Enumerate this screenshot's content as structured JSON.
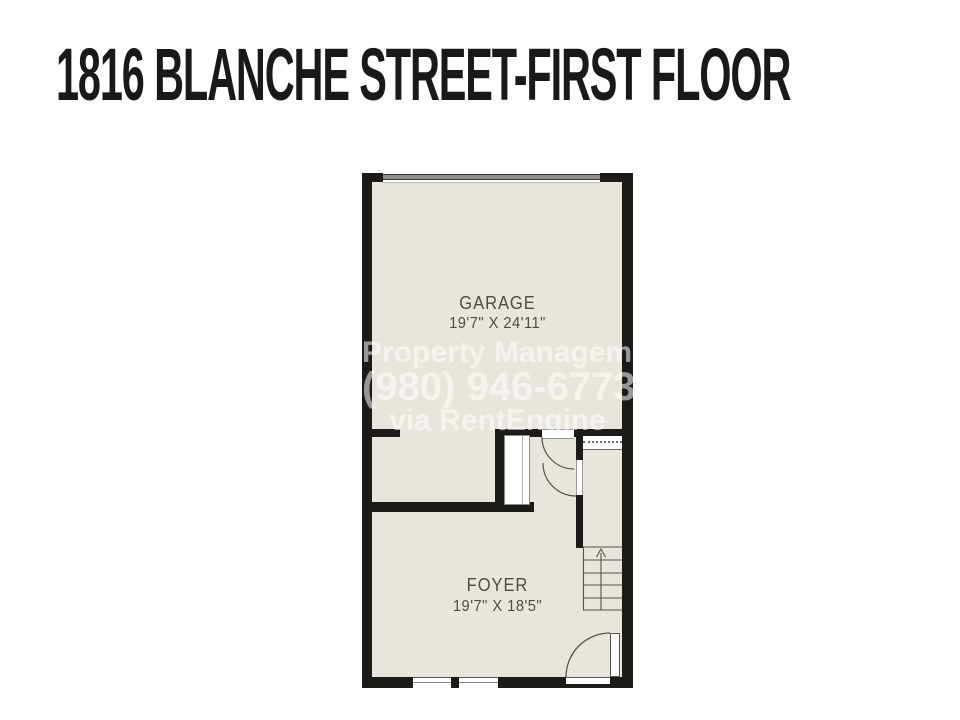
{
  "title": "1816 BLANCHE STREET-FIRST FLOOR",
  "floorplan": {
    "rooms": [
      {
        "name": "GARAGE",
        "dims": "19'7\" X 24'11\""
      },
      {
        "name": "FOYER",
        "dims": "19'7\" X 18'5\""
      }
    ],
    "watermark": {
      "line1": "Property Management",
      "line2": "(980) 946-6773",
      "line3": "via RentEngine"
    },
    "stairs": {
      "direction": "up"
    },
    "colors": {
      "wall": "#1d1b18",
      "floor": "#e9e5dc",
      "label": "#4e4c47",
      "background": "#ffffff",
      "watermark": "rgba(255,255,255,0.55)"
    }
  }
}
